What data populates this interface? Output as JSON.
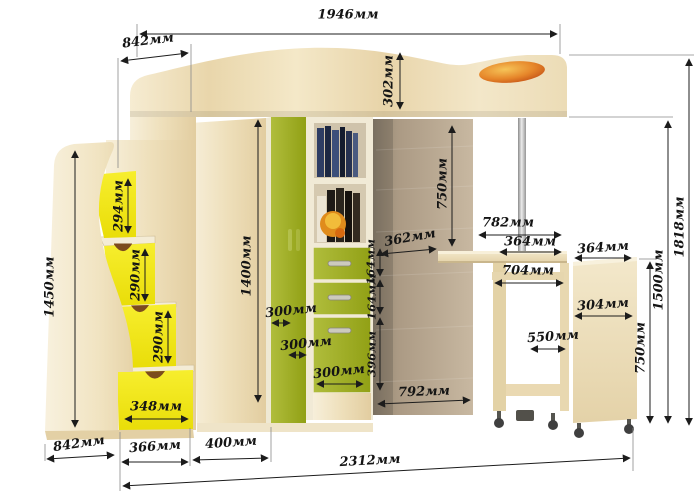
{
  "units_suffix": "мм",
  "colors": {
    "wood_light": "#f2e6c6",
    "wood_cream": "#f6efdb",
    "drawer_yellow": "#f0e515",
    "wardrobe_green": "#a4b229",
    "back_panel_tan": "#b3a28c",
    "accent_orange": "#e07b1e",
    "chrome_pole": "#b9b9b9",
    "dimension_line": "#1c1c1c"
  },
  "dims": {
    "width_top": "1946мм",
    "depth_top": "842мм",
    "headboard_height": "302мм",
    "stairs_height": "1450мм",
    "step1_height": "294мм",
    "step2_height": "290мм",
    "step3_height": "290мм",
    "bottom_drawer_width": "348мм",
    "wardrobe_height": "1400мм",
    "wardrobe_depth_1": "300мм",
    "wardrobe_depth_2": "300мм",
    "wardrobe_depth_3": "300мм",
    "shelf_width": "362мм",
    "shelf_drawer1_height": "164мм",
    "shelf_drawer2_height": "164мм",
    "shelf_door_height": "396мм",
    "underbed_clearance": "750мм",
    "desk_width": "782мм",
    "desk_section_width": "364мм",
    "cabinet_top_width": "364мм",
    "desk_opening_width": "704мм",
    "cabinet_width": "304мм",
    "desk_depth": "550мм",
    "desk_height": "750мм",
    "bed_platform_height": "1500мм",
    "total_height": "1818мм",
    "underdesk_width": "792мм",
    "stairs_depth": "842мм",
    "stairs_section_width": "366мм",
    "wardrobe_section_width": "400мм",
    "total_width": "2312мм"
  }
}
